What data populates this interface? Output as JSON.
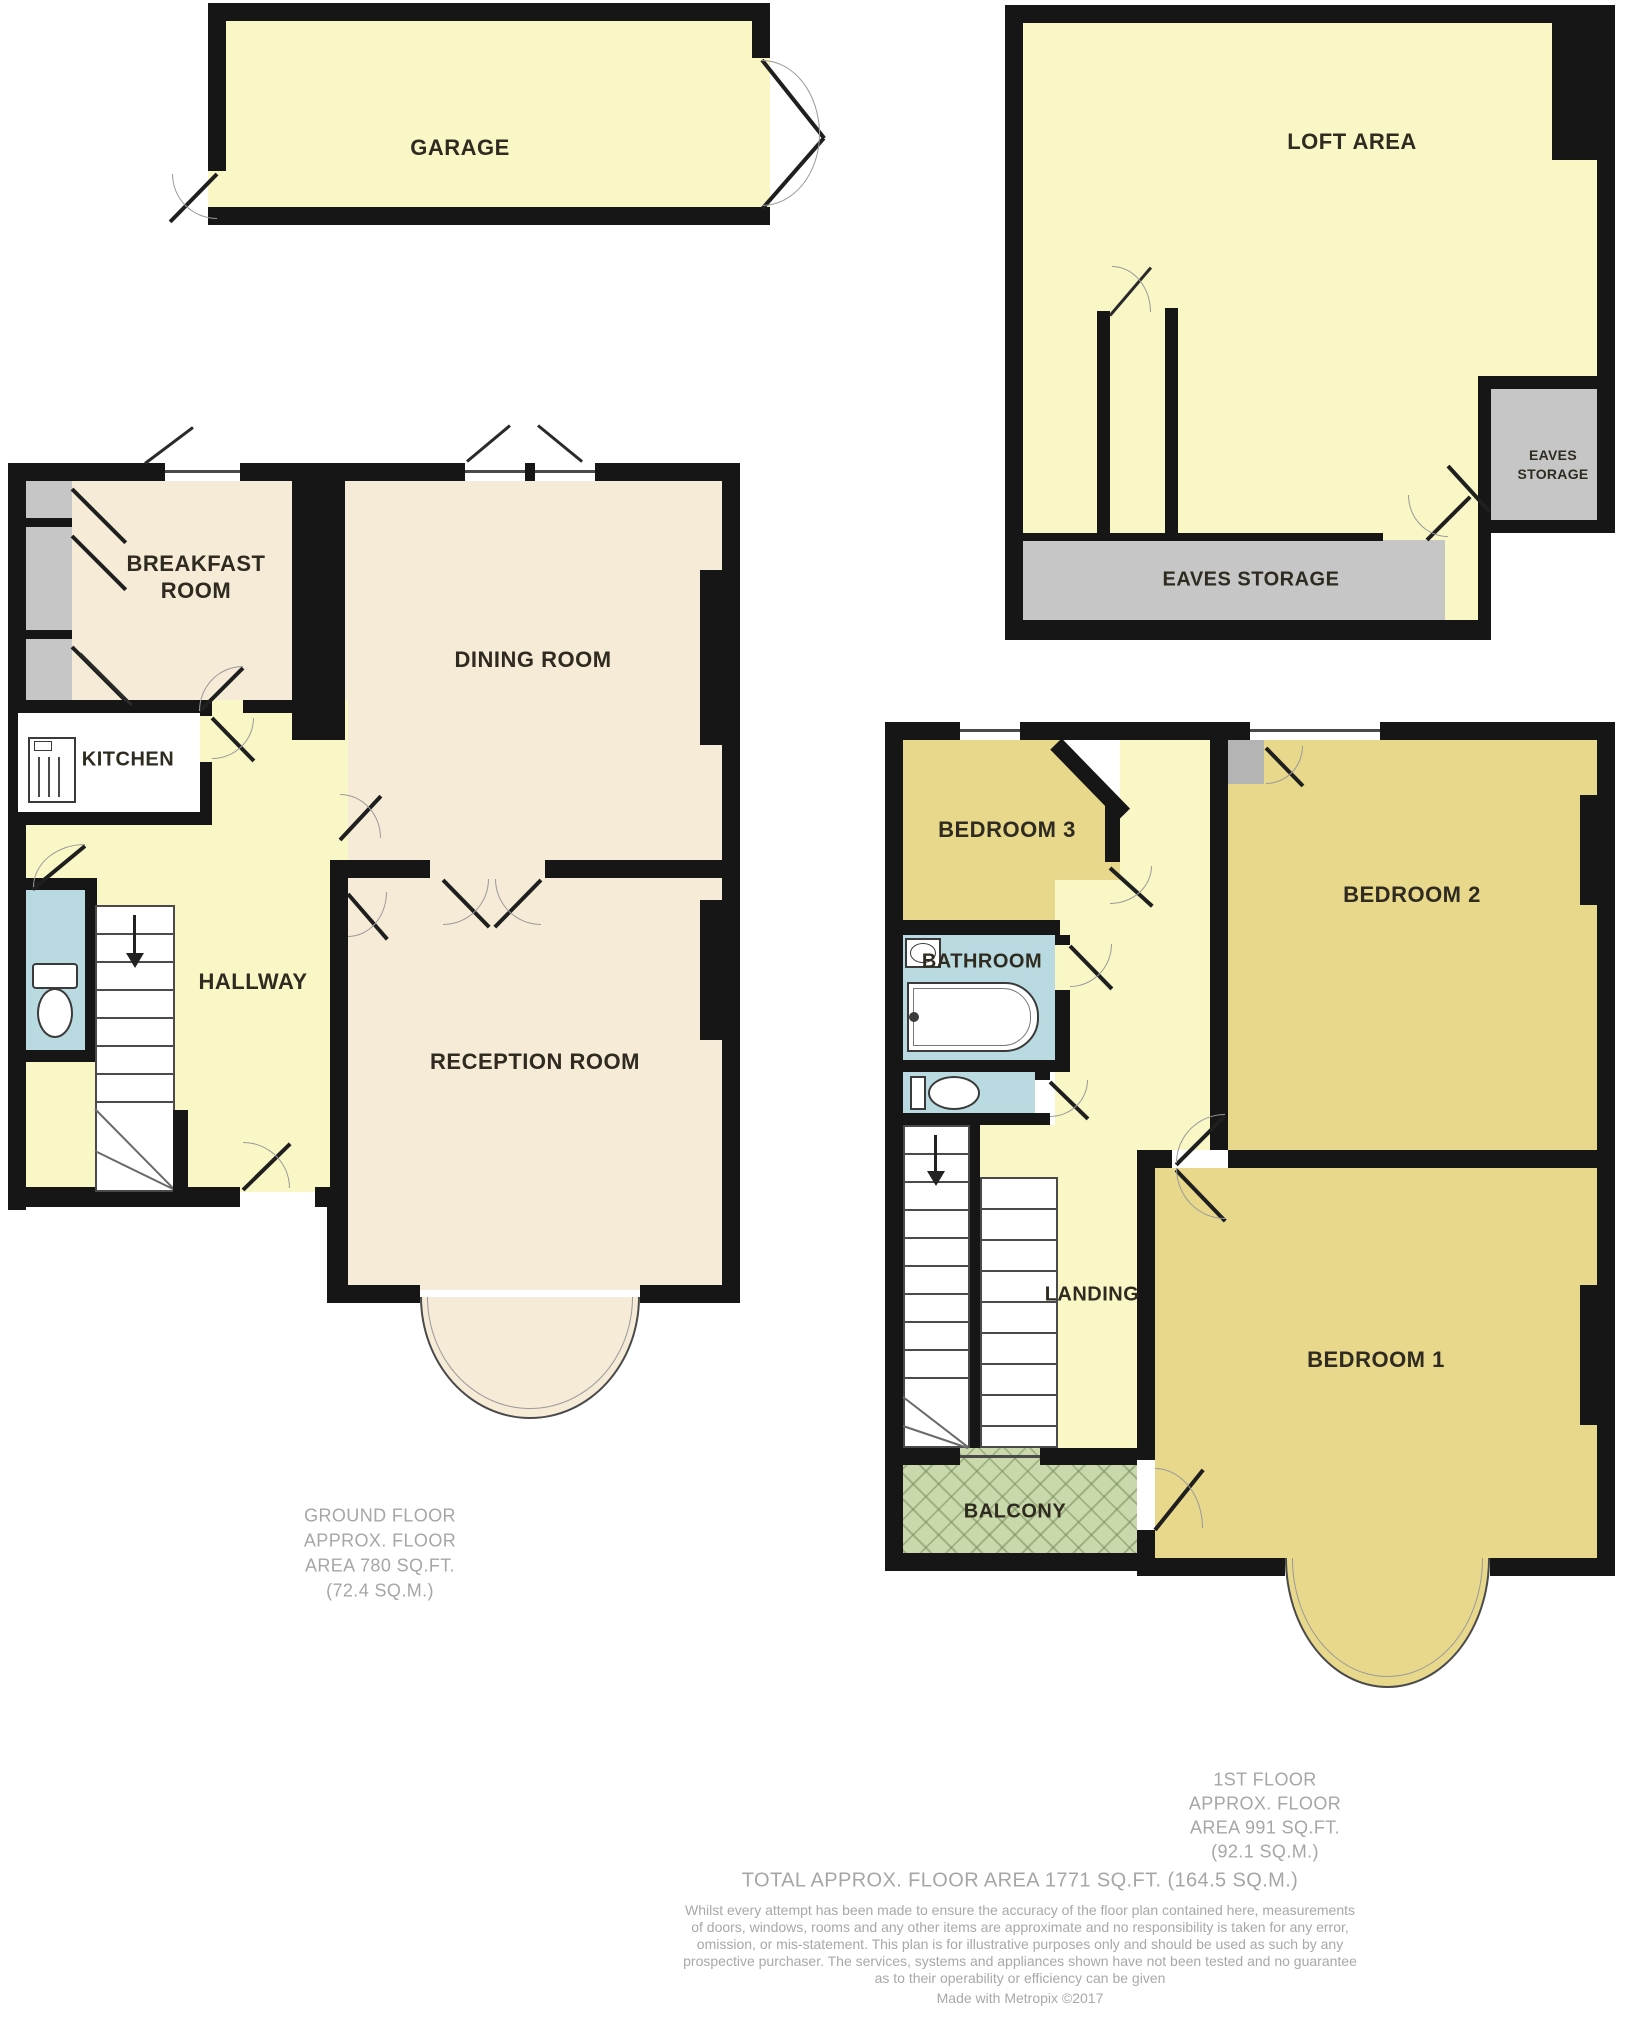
{
  "colors": {
    "wall": "#161616",
    "room_yellow": "#f9f7c5",
    "room_beige": "#f6ebd7",
    "room_khaki": "#e7d88c",
    "room_blue": "#b8dae0",
    "room_gray": "#c6c6c6",
    "balcony_green": "#cad9ab",
    "caption_gray": "#a6a6a6"
  },
  "garage": {
    "label": "GARAGE"
  },
  "loft": {
    "label": "LOFT AREA",
    "eaves_main": "EAVES STORAGE",
    "eaves_small_1": "EAVES",
    "eaves_small_2": "STORAGE"
  },
  "ground": {
    "breakfast_1": "BREAKFAST",
    "breakfast_2": "ROOM",
    "dining": "DINING ROOM",
    "kitchen": "KITCHEN",
    "hallway": "HALLWAY",
    "reception": "RECEPTION ROOM",
    "caption": [
      "GROUND FLOOR",
      "APPROX. FLOOR",
      "AREA 780 SQ.FT.",
      "(72.4 SQ.M.)"
    ]
  },
  "first": {
    "bedroom3": "BEDROOM 3",
    "bathroom": "BATHROOM",
    "bedroom2": "BEDROOM 2",
    "landing": "LANDING",
    "bedroom1": "BEDROOM 1",
    "balcony": "BALCONY",
    "caption": [
      "1ST FLOOR",
      "APPROX. FLOOR",
      "AREA 991 SQ.FT.",
      "(92.1 SQ.M.)"
    ]
  },
  "footer": {
    "total": "TOTAL APPROX. FLOOR AREA 1771 SQ.FT. (164.5 SQ.M.)",
    "disclaimer": [
      "Whilst every attempt has been made to ensure the accuracy of the floor plan contained here, measurements",
      "of doors, windows, rooms and any other items are approximate and no responsibility is taken for any error,",
      "omission, or mis-statement. This plan is for illustrative purposes only and should be used as such by any",
      "prospective purchaser. The services, systems and appliances shown have not been tested and no guarantee",
      "as to their operability or efficiency can be given"
    ],
    "credit": "Made with Metropix ©2017"
  }
}
